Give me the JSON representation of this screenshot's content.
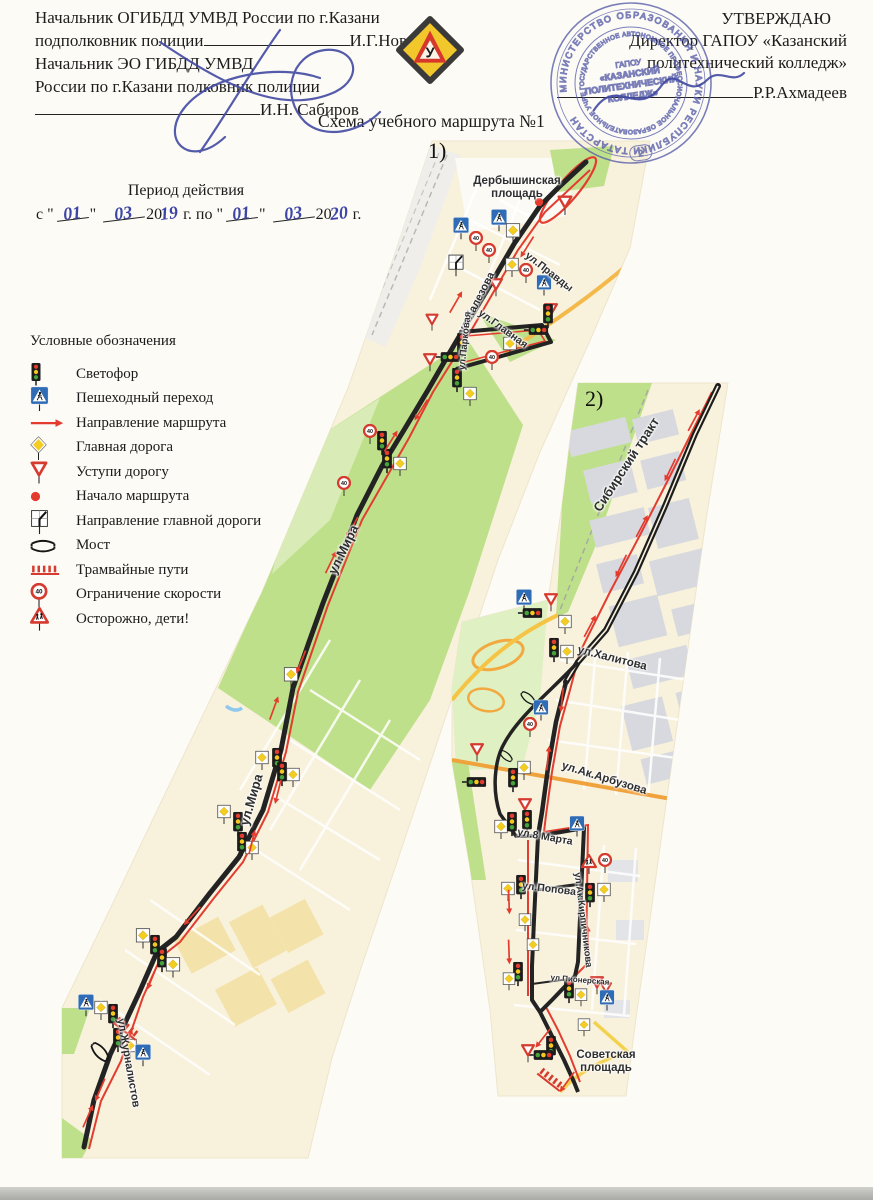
{
  "header": {
    "left": {
      "line1": "Начальник ОГИБДД УМВД России по г.Казани",
      "line2_label": "подполковник полиции",
      "line2_name": "И.Г.Новиков",
      "line3": "Начальник ЭО ГИБДД УМВД",
      "line4": "России по г.Казани полковник полиции",
      "line5_name": "И.Н. Сабиров"
    },
    "right": {
      "approve": "УТВЕРЖДАЮ",
      "line1": "Директор ГАПОУ «Казанский",
      "line2": "политехнический колледж»",
      "name": "Р.Р.Ахмадеев"
    },
    "emblem_letter": "У"
  },
  "title": "Схема учебного маршрута №1",
  "period": {
    "caption": "Период действия",
    "p1": "с \"",
    "d1": "01",
    "p2": "\"",
    "m1": "03",
    "p3": "20",
    "y1": "19",
    "p4": "г. по \"",
    "d2": "01",
    "p5": "\"",
    "m2": "03",
    "p6": "20",
    "y2": "20",
    "p7": "г."
  },
  "stamp": {
    "outer_ring": "МИНИСТЕРСТВО ОБРАЗОВАНИЯ И НАУКИ РЕСПУБЛИКИ ТАТАРСТАН",
    "inner_ring": "ГОСУДАРСТВЕННОЕ АВТОНОМНОЕ ПРОФЕССИОНАЛЬНОЕ ОБРАЗОВАТЕЛЬНОЕ УЧРЕЖДЕНИЕ",
    "center1": "ГАПОУ",
    "center2": "«КАЗАНСКИЙ",
    "center3": "ПОЛИТЕХНИЧЕСКИЙ",
    "center4": "КОЛЛЕДЖ»",
    "number": "2"
  },
  "legend": {
    "title": "Условные обозначения",
    "items": [
      {
        "icon": "traffic-light",
        "label": "Светофор"
      },
      {
        "icon": "pedestrian-crossing",
        "label": "Пешеходный переход"
      },
      {
        "icon": "route-direction",
        "label": "Направление маршрута"
      },
      {
        "icon": "main-road",
        "label": "Главная дорога"
      },
      {
        "icon": "yield",
        "label": "Уступи дорогу"
      },
      {
        "icon": "route-start",
        "label": "Начало маршрута"
      },
      {
        "icon": "main-road-direction",
        "label": "Направление главной дороги"
      },
      {
        "icon": "bridge",
        "label": "Мост"
      },
      {
        "icon": "tram-tracks",
        "label": "Трамвайные пути"
      },
      {
        "icon": "speed-limit",
        "label": "Ограничение скорости"
      },
      {
        "icon": "children",
        "label": "Осторожно, дети!"
      }
    ]
  },
  "map_symbols": {
    "speed_limit_text": "40"
  },
  "maps": {
    "map1": {
      "label": "1)",
      "labels": [
        {
          "text": "Дербышинская площадь",
          "x": 517,
          "y": 188,
          "rot": 0,
          "size": 11.5,
          "w": 118
        },
        {
          "text": "ул.Халезова",
          "x": 477,
          "y": 303,
          "rot": -63,
          "size": 11
        },
        {
          "text": "ул.Парковая",
          "x": 466,
          "y": 341,
          "rot": -84,
          "size": 9.5
        },
        {
          "text": "ул.Главная",
          "x": 503,
          "y": 329,
          "rot": 36,
          "size": 10.5
        },
        {
          "text": "ул.Правды",
          "x": 549,
          "y": 272,
          "rot": 38,
          "size": 10.5
        },
        {
          "text": "ул.Мира",
          "x": 344,
          "y": 550,
          "rot": -64,
          "size": 13
        },
        {
          "text": "ул.Мира",
          "x": 252,
          "y": 800,
          "rot": -74,
          "size": 13
        },
        {
          "text": "ул.Журналистов",
          "x": 128,
          "y": 1063,
          "rot": 80,
          "size": 11
        }
      ],
      "signs": [
        [
          "dot",
          539,
          202
        ],
        [
          "yield",
          565,
          205,
          0,
          16
        ],
        [
          "ped",
          461,
          228,
          0,
          17
        ],
        [
          "ped",
          499,
          220,
          0,
          17
        ],
        [
          "board",
          513,
          233,
          0,
          16
        ],
        [
          "s40",
          476,
          241
        ],
        [
          "s40",
          489,
          253
        ],
        [
          "dir",
          456,
          265
        ],
        [
          "board",
          512,
          267
        ],
        [
          "yield",
          496,
          287
        ],
        [
          "s40",
          526,
          273
        ],
        [
          "ped",
          544,
          285,
          0,
          16
        ],
        [
          "yield",
          551,
          312
        ],
        [
          "tl",
          548,
          316
        ],
        [
          "tl",
          536,
          330,
          90
        ],
        [
          "tl",
          462,
          345
        ],
        [
          "tl",
          448,
          357,
          90
        ],
        [
          "yield",
          430,
          362
        ],
        [
          "yield",
          432,
          322,
          0,
          14
        ],
        [
          "board",
          510,
          346
        ],
        [
          "s40",
          492,
          360
        ],
        [
          "tl",
          457,
          380
        ],
        [
          "board",
          470,
          396
        ],
        [
          "s40",
          370,
          434
        ],
        [
          "tl",
          382,
          443
        ],
        [
          "tl",
          387,
          461
        ],
        [
          "board",
          400,
          466
        ],
        [
          "s40",
          344,
          486
        ],
        [
          "board",
          291,
          677,
          0,
          16
        ],
        [
          "board",
          262,
          760
        ],
        [
          "tl",
          277,
          760
        ],
        [
          "tl",
          282,
          774
        ],
        [
          "board",
          293,
          777
        ],
        [
          "board",
          224,
          814
        ],
        [
          "tl",
          238,
          824
        ],
        [
          "tl",
          242,
          844
        ],
        [
          "board",
          252,
          850
        ],
        [
          "board",
          143,
          938,
          0,
          16
        ],
        [
          "tl",
          155,
          947
        ],
        [
          "tl",
          162,
          960
        ],
        [
          "board",
          173,
          967,
          0,
          16
        ],
        [
          "ped",
          86,
          1005,
          0,
          17
        ],
        [
          "board",
          101,
          1010
        ],
        [
          "tl",
          113,
          1016
        ],
        [
          "tl",
          118,
          1040
        ],
        [
          "board",
          130,
          1048
        ],
        [
          "ped",
          143,
          1055,
          0,
          17
        ],
        [
          "tram",
          127,
          1028,
          38
        ],
        [
          "bridge",
          100,
          1052,
          48
        ],
        [
          "arrow",
          527,
          247,
          122
        ],
        [
          "arrow",
          456,
          302,
          -60
        ],
        [
          "arrow",
          421,
          410,
          122
        ],
        [
          "arrow",
          391,
          441,
          -58
        ],
        [
          "arrow",
          352,
          528,
          118
        ],
        [
          "arrow",
          331,
          562,
          -64
        ],
        [
          "arrow",
          301,
          662,
          112
        ],
        [
          "arrow",
          274,
          708,
          -70
        ],
        [
          "arrow",
          278,
          792,
          104
        ],
        [
          "arrow",
          252,
          842,
          -76
        ],
        [
          "arrow",
          192,
          916,
          132
        ],
        [
          "arrow",
          152,
          978,
          112
        ],
        [
          "arrow",
          128,
          1040,
          -70
        ],
        [
          "arrow",
          100,
          1090,
          113
        ],
        [
          "arrow",
          88,
          1116,
          -66
        ]
      ]
    },
    "map2": {
      "label": "2)",
      "labels": [
        {
          "text": "Сибирский тракт",
          "x": 627,
          "y": 465,
          "rot": -57,
          "size": 13
        },
        {
          "text": "ул.Халитова",
          "x": 612,
          "y": 659,
          "rot": 14,
          "size": 11.5
        },
        {
          "text": "ул.Ак.Арбузова",
          "x": 604,
          "y": 779,
          "rot": 17,
          "size": 11.5
        },
        {
          "text": "ул.8 Марта",
          "x": 545,
          "y": 837,
          "rot": 10,
          "size": 10.5
        },
        {
          "text": "ул.Попова",
          "x": 549,
          "y": 889,
          "rot": 7,
          "size": 10.5
        },
        {
          "text": "ул.Ак.Кирпичникова",
          "x": 582,
          "y": 920,
          "rot": 83,
          "size": 9.5
        },
        {
          "text": "ул.Пионерская",
          "x": 580,
          "y": 980,
          "rot": 5,
          "size": 8
        },
        {
          "text": "Советская площадь",
          "x": 606,
          "y": 1062,
          "rot": 0,
          "size": 11.5,
          "w": 92
        }
      ],
      "signs": [
        [
          "ped",
          524,
          600,
          0,
          17
        ],
        [
          "tl",
          530,
          613,
          90
        ],
        [
          "yield",
          551,
          602
        ],
        [
          "board",
          565,
          624
        ],
        [
          "tl",
          554,
          650
        ],
        [
          "board",
          567,
          654
        ],
        [
          "bridge",
          528,
          698,
          40,
          18
        ],
        [
          "ped",
          541,
          710,
          0,
          16
        ],
        [
          "s40",
          530,
          727
        ],
        [
          "bridge",
          506,
          756,
          40,
          16
        ],
        [
          "yield",
          477,
          752
        ],
        [
          "tl",
          474,
          782,
          90
        ],
        [
          "board",
          524,
          770
        ],
        [
          "tl",
          513,
          780
        ],
        [
          "yield",
          525,
          807
        ],
        [
          "board",
          501,
          829
        ],
        [
          "tl",
          512,
          824
        ],
        [
          "tl",
          527,
          822
        ],
        [
          "ped",
          577,
          826,
          0,
          16
        ],
        [
          "kids",
          589,
          864,
          0,
          16
        ],
        [
          "s40",
          605,
          863
        ],
        [
          "board",
          508,
          891
        ],
        [
          "tl",
          521,
          887
        ],
        [
          "tl",
          590,
          895
        ],
        [
          "board",
          604,
          892
        ],
        [
          "board",
          525,
          922,
          0,
          14
        ],
        [
          "board",
          533,
          947,
          0,
          14
        ],
        [
          "tl",
          518,
          974
        ],
        [
          "board",
          509,
          981,
          0,
          14
        ],
        [
          "tl",
          569,
          991
        ],
        [
          "board",
          581,
          997,
          0,
          14
        ],
        [
          "yield",
          597,
          985
        ],
        [
          "yield",
          606,
          990,
          0,
          13
        ],
        [
          "ped",
          607,
          1000,
          0,
          16
        ],
        [
          "board",
          584,
          1027,
          0,
          14
        ],
        [
          "tl",
          551,
          1048
        ],
        [
          "tl",
          541,
          1055,
          90
        ],
        [
          "yield",
          528,
          1053
        ],
        [
          "tram",
          551,
          1079,
          38
        ],
        [
          "arrow",
          694,
          420,
          -62
        ],
        [
          "arrow",
          670,
          470,
          116
        ],
        [
          "arrow",
          642,
          526,
          -62
        ],
        [
          "arrow",
          621,
          566,
          116
        ],
        [
          "arrow",
          590,
          626,
          -62
        ],
        [
          "arrow",
          562,
          700,
          96
        ],
        [
          "arrow",
          548,
          758,
          -84
        ],
        [
          "arrow",
          588,
          938,
          -92
        ],
        [
          "arrow",
          509,
          902,
          88
        ],
        [
          "arrow",
          509,
          952,
          88
        ],
        [
          "arrow",
          543,
          1038,
          128
        ],
        [
          "arrow",
          567,
          1082,
          126
        ]
      ]
    }
  }
}
